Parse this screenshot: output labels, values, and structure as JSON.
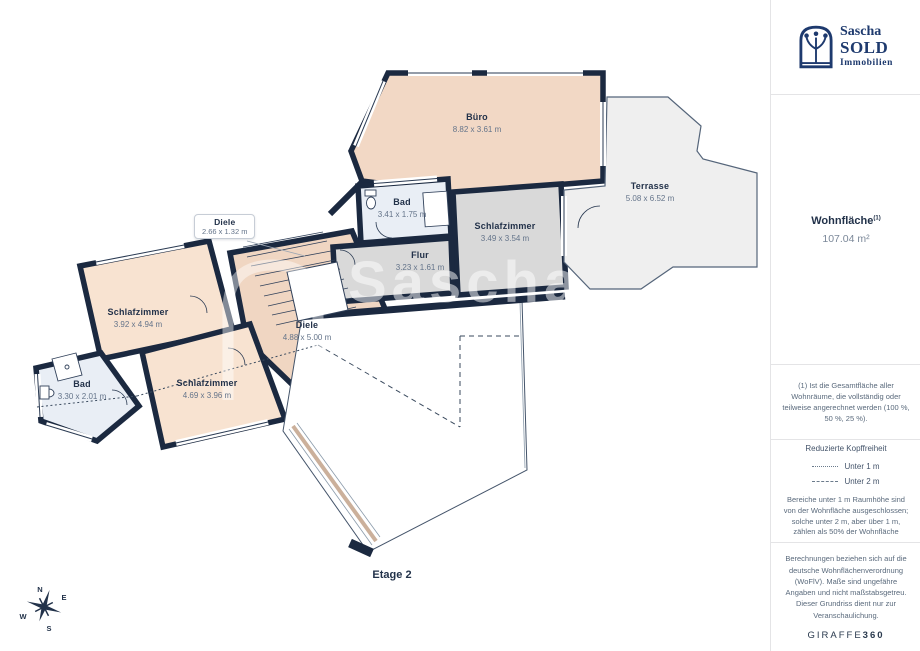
{
  "logo": {
    "line1": "Sascha",
    "line2": "SOLD",
    "line3": "Immobilien"
  },
  "sidebar": {
    "area_label": "Wohnfläche",
    "area_superscript": "(1)",
    "area_value": "107.04 m²",
    "footnote": "(1) Ist die Gesamtfläche aller Wohnräume, die vollständig oder teilweise angerechnet werden (100 %, 50 %, 25 %).",
    "legend": {
      "title": "Reduzierte Kopffreiheit",
      "items": [
        {
          "label": "Unter 1 m",
          "style": "dotted-dense"
        },
        {
          "label": "Unter 2 m",
          "style": "dashed-sparse"
        }
      ],
      "note": "Bereiche unter 1 m Raumhöhe sind von der Wohnfläche ausgeschlossen; solche unter 2 m, aber über 1 m, zählen als 50% der Wohnfläche"
    },
    "disclaimer": "Berechnungen beziehen sich auf die deutsche Wohnflächenverordnung (WoFlV). Maße sind ungefähre Angaben und nicht maßstabsgetreu. Dieser Grundriss dient nur zur Veranschaulichung.",
    "brand": {
      "name": "GIRAFFE",
      "suffix": "360"
    }
  },
  "floorplan": {
    "floor_label": "Etage 2",
    "watermark_line1": "Sascha",
    "watermark_line2": "S",
    "compass": {
      "n": "N",
      "e": "E",
      "s": "S",
      "w": "W"
    },
    "rooms": [
      {
        "id": "buero",
        "name": "Büro",
        "dims": "8.82 x 3.61 m"
      },
      {
        "id": "bad_og",
        "name": "Bad",
        "dims": "3.41 x 1.75 m"
      },
      {
        "id": "schlafzimmer_right",
        "name": "Schlafzimmer",
        "dims": "3.49 x 3.54 m"
      },
      {
        "id": "terrasse",
        "name": "Terrasse",
        "dims": "5.08 x 6.52 m"
      },
      {
        "id": "flur",
        "name": "Flur",
        "dims": "3.23 x 1.61 m"
      },
      {
        "id": "diele_klein",
        "name": "Diele",
        "dims": "2.66 x 1.32 m"
      },
      {
        "id": "schlafzimmer_left",
        "name": "Schlafzimmer",
        "dims": "3.92 x 4.94 m"
      },
      {
        "id": "bad_left",
        "name": "Bad",
        "dims": "3.30 x 2.01 m"
      },
      {
        "id": "schlafzimmer_bottom",
        "name": "Schlafzimmer",
        "dims": "4.69 x 3.96 m"
      },
      {
        "id": "diele_center",
        "name": "Diele",
        "dims": "4.88 x 5.00 m"
      }
    ],
    "colors": {
      "wall": "#1b2940",
      "room_warm": "#f2d8c5",
      "room_warm_light": "#f8e3d1",
      "room_bath": "#e9eef5",
      "room_gray": "#d9d9d9",
      "terrace": "#efefef",
      "brand_navy": "#1e3a6e",
      "label_text": "#23324a",
      "dims_text": "#64748a"
    }
  }
}
